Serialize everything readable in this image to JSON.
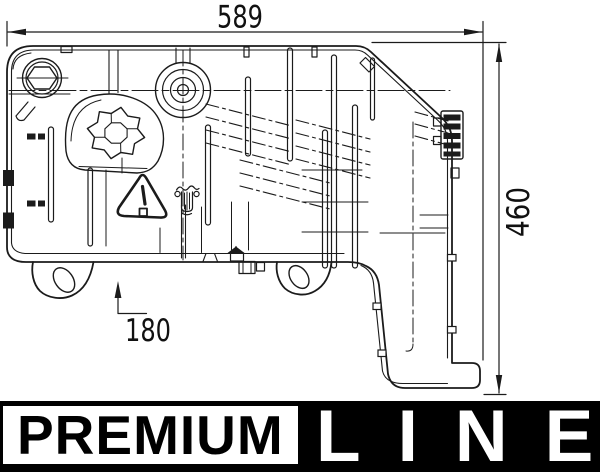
{
  "drawing": {
    "dim_width_label": "589",
    "dim_height_label": "460",
    "dim_offset_label": "180"
  },
  "banner": {
    "premium_label": "PREMIUM",
    "line_label": "LINE",
    "bar_color": "#000000",
    "box_color": "#ffffff",
    "text_color": "#ffffff"
  },
  "icons": {
    "warning_triangle": "exclamation-warning-triangle",
    "coolant_cap": "pressure-cap-warning-symbol",
    "filler_hex": "hex-filler-plug",
    "expansion_cap": "knurled-expansion-cap"
  },
  "colors": {
    "line": "#1b1b1b",
    "background": "#ffffff"
  }
}
